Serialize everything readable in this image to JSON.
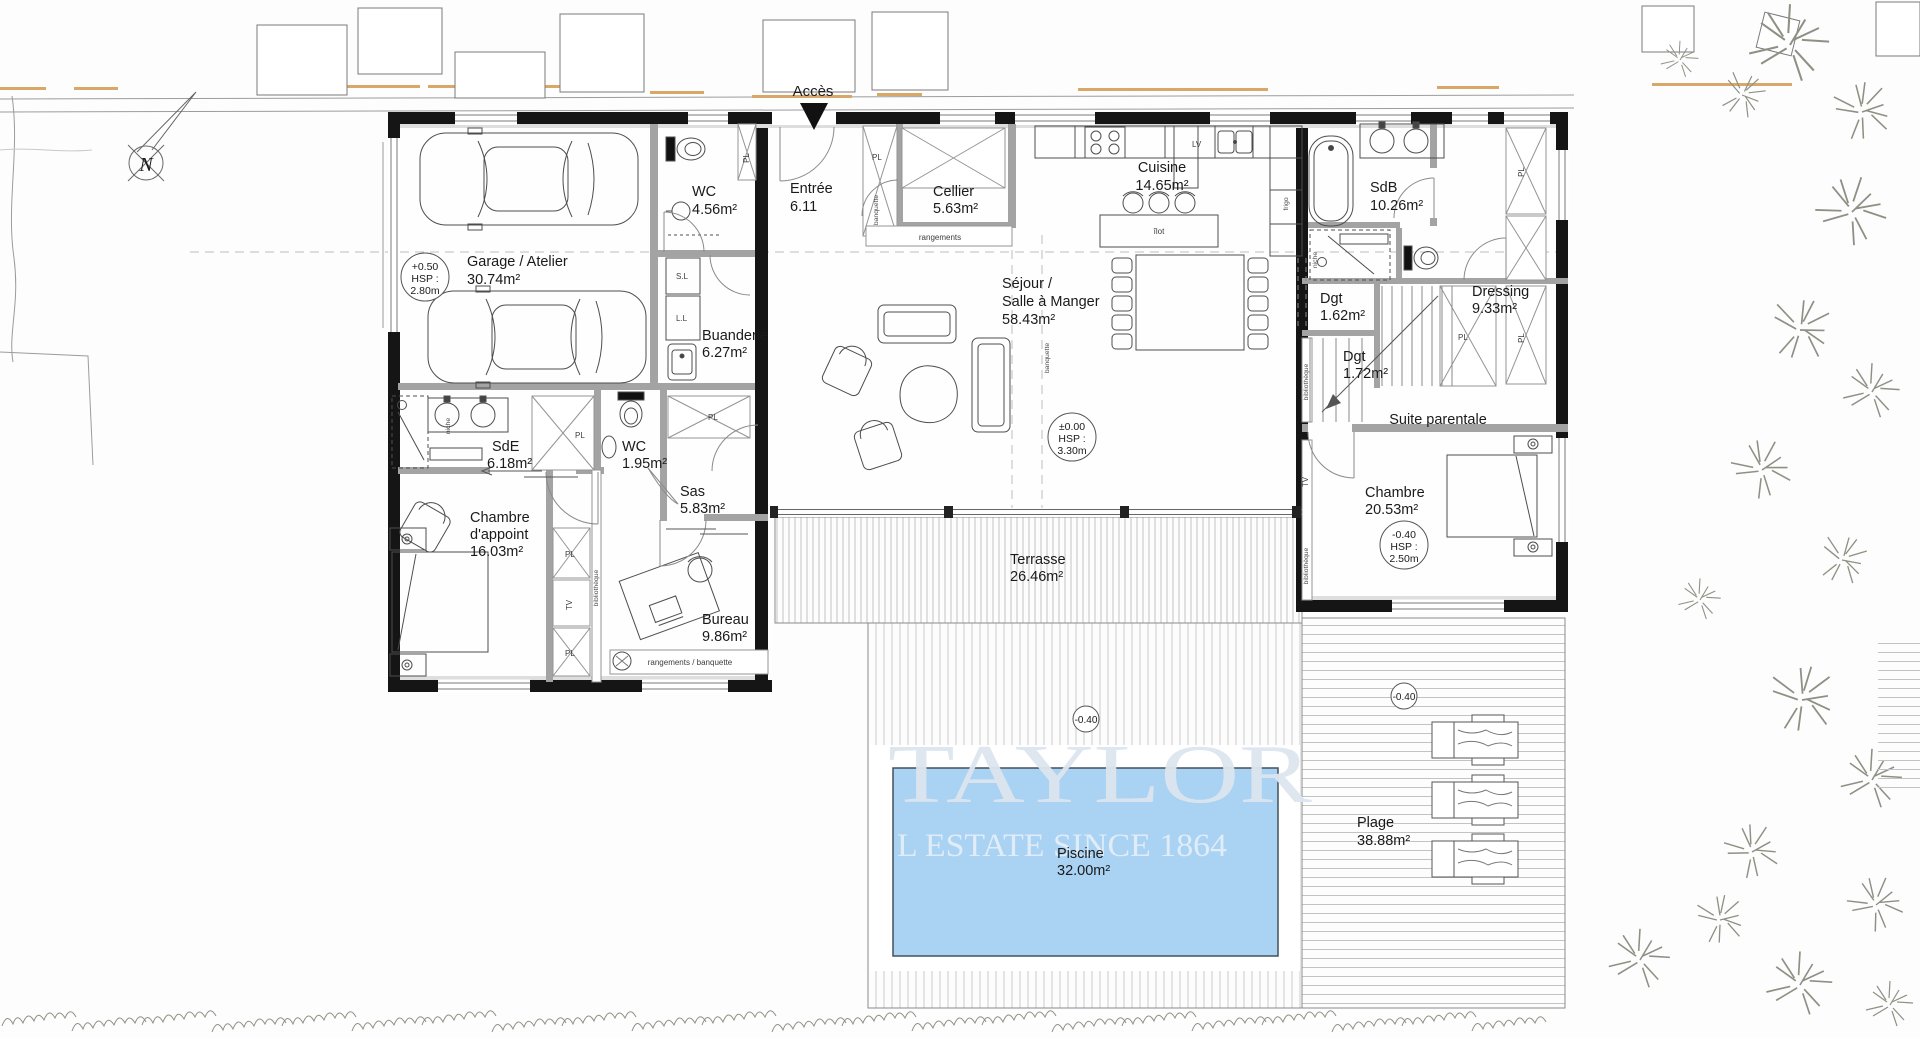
{
  "site": {
    "acces_label": "Accès",
    "compass_n": "N"
  },
  "watermark": {
    "line1": "TAYLOR",
    "line2": "L ESTATE SINCE 1864"
  },
  "levels": {
    "garage": {
      "level": "+0.50",
      "hsp": "HSP :",
      "height": "2.80m"
    },
    "sejour": {
      "level": "±0.00",
      "hsp": "HSP :",
      "height": "3.30m"
    },
    "suite": {
      "level": "-0.40",
      "hsp": "HSP :",
      "height": "2.50m"
    },
    "deck_marker": "-0.40",
    "plage_marker": "-0.40"
  },
  "rooms": {
    "garage": {
      "name": "Garage / Atelier",
      "area": "30.74m²"
    },
    "wc_garage": {
      "name": "WC",
      "area": "4.56m²"
    },
    "entree": {
      "name": "Entrée",
      "area": "6.11"
    },
    "cellier": {
      "name": "Cellier",
      "area": "5.63m²"
    },
    "cuisine": {
      "name": "Cuisine",
      "area": "14.65m²"
    },
    "sejour": {
      "name_line1": "Séjour /",
      "name_line2": "Salle à Manger",
      "area": "58.43m²"
    },
    "sdb": {
      "name": "SdB",
      "area": "10.26m²"
    },
    "dressing": {
      "name": "Dressing",
      "area": "9.33m²"
    },
    "dgt1": {
      "name": "Dgt",
      "area": "1.62m²"
    },
    "dgt2": {
      "name": "Dgt",
      "area": "1.72m²"
    },
    "buanderie": {
      "name": "Buanderie",
      "area": "6.27m²"
    },
    "sde": {
      "name": "SdE",
      "area": "6.18m²"
    },
    "wc2": {
      "name": "WC",
      "area": "1.95m²"
    },
    "sas": {
      "name": "Sas",
      "area": "5.83m²"
    },
    "chambre_appoint": {
      "name_line1": "Chambre",
      "name_line2": "d'appoint",
      "area": "16.03m²"
    },
    "bureau": {
      "name": "Bureau",
      "area": "9.86m²"
    },
    "suite_parentale": {
      "name": "Suite parentale"
    },
    "chambre_suite": {
      "name": "Chambre",
      "area": "20.53m²"
    },
    "terrasse": {
      "name": "Terrasse",
      "area": "26.46m²"
    },
    "piscine": {
      "name": "Piscine",
      "area": "32.00m²"
    },
    "plage": {
      "name": "Plage",
      "area": "38.88m²"
    }
  },
  "fixtures": {
    "pl": "PL",
    "tv": "TV",
    "bibliotheque": "bibliothèque",
    "niche": "niche",
    "sl": "S.L",
    "ll": "L.L",
    "lv": "LV",
    "frigo": "frigo",
    "ilot": "îlot",
    "rangements": "rangements",
    "rangements_banquette": "rangements / banquette",
    "banquette": "banquette"
  },
  "colors": {
    "pool": "#a9d2f3",
    "accent_dash": "#d9a868",
    "wall": "#151515"
  }
}
